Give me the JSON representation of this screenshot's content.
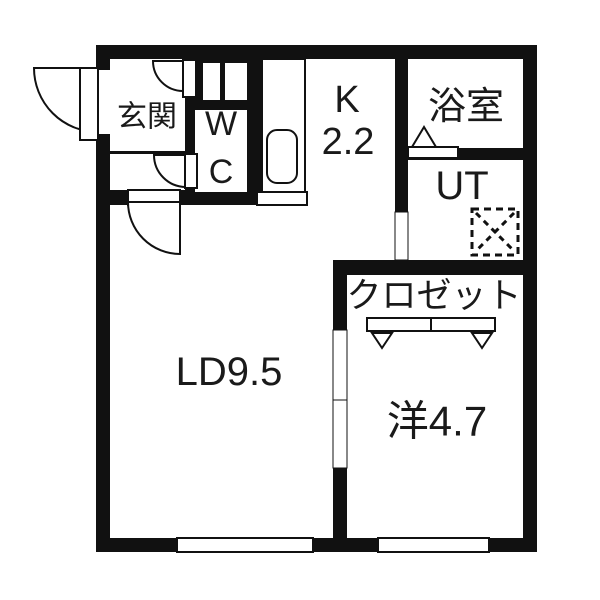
{
  "rooms": {
    "genkan": {
      "label": "玄関"
    },
    "wc": {
      "line1": "W",
      "line2": "C"
    },
    "kitchen": {
      "label": "K",
      "area": "2.2"
    },
    "bath": {
      "label": "浴室"
    },
    "utility": {
      "label": "UT"
    },
    "closet": {
      "label": "クロゼット"
    },
    "living_dining": {
      "label": "LD9.5"
    },
    "western_room": {
      "label": "洋4.7"
    }
  },
  "colors": {
    "wall": "#111111",
    "background": "#ffffff",
    "text": "#1a1a1a"
  }
}
